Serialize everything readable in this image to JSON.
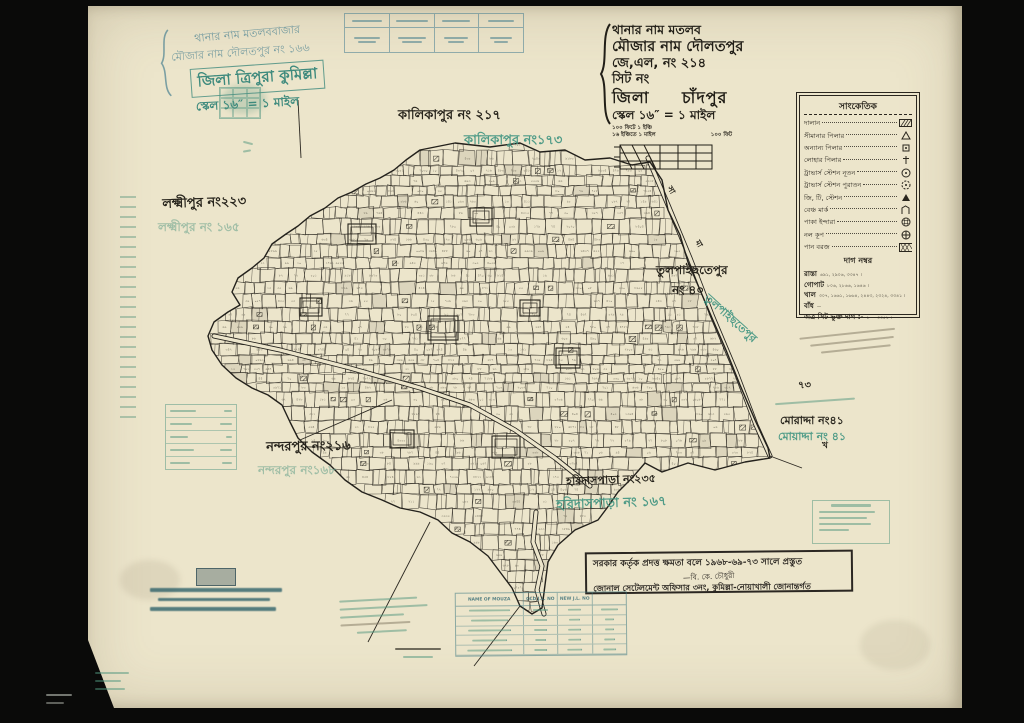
{
  "sheet": {
    "kind": "cadastral-mouza-map",
    "paper_color": "#ece5cb",
    "black_ink": "#26231b",
    "teal_ink": "#47898b",
    "green_ink": "#3f9480"
  },
  "title_left": {
    "line1": "থানার নাম মতলববাজার",
    "line2": "মৌজার নাম দৌলতপুর নং ১৬৬",
    "district_box": "জিলা ত্রিপুরা কুমিল্লা",
    "scale": "স্কেল ১৬″ = ১ মাইল"
  },
  "header_right": {
    "thana": "থানার নাম মতলব",
    "mouza": "মৌজার নাম দৌলতপুর",
    "jl_no": "জে,এল, নং ২১৪",
    "sheet_no": "সিট নং",
    "district_label": "জিলা",
    "district_value": "চাঁদপুর",
    "scale": "স্কেল ১৬″ = ১ মাইল",
    "scale_note1": "১০০ ফিটে  ১ ইঞ্চি",
    "scale_note2": "১৬ ইঞ্চিতে  ১ মাইল",
    "scale_note3": "১০০ ফিট"
  },
  "legend": {
    "title": "সাংকেতিক",
    "items": [
      {
        "label": "দালান",
        "symbol": "building-hatch"
      },
      {
        "label": "সীমানার পিলার",
        "symbol": "triangle-outline"
      },
      {
        "label": "অন্যান্য পিলার",
        "symbol": "square-dot"
      },
      {
        "label": "লোহার পিলার",
        "symbol": "iron-cross"
      },
      {
        "label": "ট্রাভার্স স্টেশন নূতন",
        "symbol": "circle-dot"
      },
      {
        "label": "ট্রাভার্স স্টেশন পুরাতন",
        "symbol": "circle-dashed"
      },
      {
        "label": "জি, টি, স্টেশন",
        "symbol": "triangle-filled"
      },
      {
        "label": "বেঞ্চ মার্ক",
        "symbol": "bench-mark"
      },
      {
        "label": "পাকা ইন্দারা",
        "symbol": "masonry-well"
      },
      {
        "label": "নল কূপ",
        "symbol": "tube-well"
      },
      {
        "label": "পান বরজ",
        "symbol": "pan-crosshatch"
      }
    ],
    "dag_title": "দাগ নম্বর",
    "dag_rows": [
      {
        "label": "রাস্তা",
        "value": "৬৯১, ২৯০৬, ৩৩৪৭ ।"
      },
      {
        "label": "গোপাট",
        "value": "৮০৬, ২৮৬৬, ১৬৪৬ ।"
      },
      {
        "label": "খাল",
        "value": "৩০৭, ১৬৬১, ১৬৬৪, ২৪৪৩, ২৩২৪, ৩৩৪১ ।"
      },
      {
        "label": "বাঁধ",
        "value": "—"
      },
      {
        "label": "অত্র সিট ভুক্ত দাগ :-",
        "value": "১ — ৩৩৫১ ।"
      }
    ]
  },
  "stamp_box": {
    "line1": "সরকার কর্তৃক প্রদত্ত ক্ষমতা বলে ১৯৬৮-৬৯-৭৩ সালে প্রস্তুত",
    "signature": "—বি. কে. চৌধুরী",
    "line2": "জোনাল সেটেলমেন্ট অফিসার ৩নং, কুমিল্লা-নোয়াখালী জোনান্তর্গত"
  },
  "bottom_table": {
    "headers": [
      "NAME OF MOUZA",
      "OLD J.L. NO",
      "NEW J.L. NO",
      ""
    ]
  },
  "map_labels": [
    {
      "text": "কালিকাপুর নং ২১৭",
      "x": 398,
      "y": 106,
      "size": 13,
      "color": "black",
      "rot": 0
    },
    {
      "text": "কালিকাপুর নং১৭৩",
      "x": 464,
      "y": 131,
      "size": 13,
      "color": "green",
      "rot": 0
    },
    {
      "text": "লক্ষ্মীপুর নং২২৩",
      "x": 162,
      "y": 195,
      "size": 13,
      "color": "black",
      "rot": -2
    },
    {
      "text": "লক্ষ্মীপুর নং ১৬৫",
      "x": 158,
      "y": 219,
      "size": 12,
      "color": "faint",
      "rot": 0
    },
    {
      "text": "তুলপাইছতেপুর",
      "x": 656,
      "y": 262,
      "size": 12,
      "color": "black",
      "rot": 0
    },
    {
      "text": "নং ৪০",
      "x": 672,
      "y": 282,
      "size": 12,
      "color": "black",
      "rot": 0
    },
    {
      "text": "তুলপাইছতেপুর",
      "x": 712,
      "y": 290,
      "size": 11,
      "color": "green",
      "rot": 42
    },
    {
      "text": "নন্দরপুর নং২১৬",
      "x": 266,
      "y": 438,
      "size": 13,
      "color": "black",
      "rot": -1
    },
    {
      "text": "নন্দরপুর নং১৬৮",
      "x": 258,
      "y": 462,
      "size": 12,
      "color": "faint",
      "rot": 0
    },
    {
      "text": "হরিদাসপাড়া নং২৩৫",
      "x": 566,
      "y": 473,
      "size": 11,
      "color": "black",
      "rot": -2
    },
    {
      "text": "হরিদাসপাড়া নং ১৬৭",
      "x": 556,
      "y": 496,
      "size": 13,
      "color": "green",
      "rot": -2
    },
    {
      "text": "মোরাদ্দা নং৪১",
      "x": 780,
      "y": 412,
      "size": 11,
      "color": "black",
      "rot": 0
    },
    {
      "text": "মোয়াদ্দা নং ৪১",
      "x": 778,
      "y": 428,
      "size": 11,
      "color": "green",
      "rot": 0
    },
    {
      "text": "৭৩",
      "x": 798,
      "y": 378,
      "size": 10,
      "color": "black",
      "rot": 0
    },
    {
      "text": "সা",
      "x": 674,
      "y": 184,
      "size": 8,
      "color": "black",
      "rot": 60
    },
    {
      "text": "মা",
      "x": 702,
      "y": 238,
      "size": 8,
      "color": "black",
      "rot": 60
    },
    {
      "text": "খ",
      "x": 822,
      "y": 438,
      "size": 9,
      "color": "black",
      "rot": 0
    }
  ],
  "map": {
    "seed": 11,
    "digits": "০১২৩৪৫৬৭৮৯",
    "boundary": [
      [
        420,
        150
      ],
      [
        455,
        143
      ],
      [
        490,
        147
      ],
      [
        520,
        143
      ],
      [
        540,
        152
      ],
      [
        565,
        150
      ],
      [
        585,
        160
      ],
      [
        610,
        158
      ],
      [
        632,
        165
      ],
      [
        650,
        162
      ],
      [
        662,
        180
      ],
      [
        668,
        210
      ],
      [
        680,
        235
      ],
      [
        688,
        262
      ],
      [
        700,
        290
      ],
      [
        712,
        318
      ],
      [
        726,
        350
      ],
      [
        740,
        385
      ],
      [
        755,
        420
      ],
      [
        768,
        448
      ],
      [
        770,
        458
      ],
      [
        745,
        462
      ],
      [
        715,
        470
      ],
      [
        688,
        463
      ],
      [
        662,
        472
      ],
      [
        645,
        463
      ],
      [
        632,
        478
      ],
      [
        618,
        492
      ],
      [
        607,
        508
      ],
      [
        598,
        520
      ],
      [
        575,
        530
      ],
      [
        558,
        545
      ],
      [
        548,
        562
      ],
      [
        545,
        585
      ],
      [
        542,
        608
      ],
      [
        532,
        614
      ],
      [
        520,
        606
      ],
      [
        512,
        588
      ],
      [
        500,
        572
      ],
      [
        488,
        556
      ],
      [
        470,
        542
      ],
      [
        452,
        533
      ],
      [
        438,
        520
      ],
      [
        420,
        512
      ],
      [
        400,
        508
      ],
      [
        382,
        500
      ],
      [
        362,
        492
      ],
      [
        345,
        480
      ],
      [
        330,
        465
      ],
      [
        312,
        452
      ],
      [
        298,
        438
      ],
      [
        290,
        422
      ],
      [
        282,
        405
      ],
      [
        268,
        395
      ],
      [
        252,
        388
      ],
      [
        236,
        378
      ],
      [
        222,
        365
      ],
      [
        212,
        350
      ],
      [
        208,
        336
      ],
      [
        214,
        322
      ],
      [
        228,
        312
      ],
      [
        240,
        305
      ],
      [
        232,
        292
      ],
      [
        238,
        278
      ],
      [
        252,
        268
      ],
      [
        264,
        258
      ],
      [
        272,
        244
      ],
      [
        286,
        234
      ],
      [
        298,
        226
      ],
      [
        310,
        216
      ],
      [
        325,
        208
      ],
      [
        338,
        198
      ],
      [
        352,
        192
      ],
      [
        366,
        184
      ],
      [
        380,
        178
      ],
      [
        394,
        170
      ],
      [
        406,
        160
      ]
    ],
    "compounds": [
      [
        348,
        224,
        28,
        20
      ],
      [
        428,
        316,
        30,
        24
      ],
      [
        492,
        436,
        28,
        22
      ],
      [
        300,
        298,
        22,
        18
      ],
      [
        556,
        348,
        24,
        20
      ],
      [
        470,
        208,
        22,
        18
      ],
      [
        390,
        430,
        24,
        18
      ],
      [
        520,
        300,
        20,
        16
      ]
    ],
    "roads_double": [
      [
        [
          648,
          158
        ],
        [
          668,
          205
        ],
        [
          690,
          258
        ],
        [
          712,
          315
        ],
        [
          736,
          372
        ],
        [
          756,
          425
        ],
        [
          770,
          456
        ]
      ],
      [
        [
          536,
          512
        ],
        [
          533,
          542
        ],
        [
          542,
          566
        ],
        [
          537,
          590
        ],
        [
          544,
          614
        ]
      ],
      [
        [
          214,
          336
        ],
        [
          280,
          350
        ],
        [
          350,
          368
        ],
        [
          420,
          388
        ],
        [
          470,
          405
        ],
        [
          515,
          430
        ],
        [
          555,
          458
        ],
        [
          590,
          486
        ]
      ]
    ],
    "roads_single": [
      [
        [
          298,
          100
        ],
        [
          301,
          158
        ]
      ],
      [
        [
          300,
          440
        ],
        [
          392,
          400
        ]
      ],
      [
        [
          430,
          522
        ],
        [
          368,
          642
        ]
      ],
      [
        [
          520,
          606
        ],
        [
          474,
          666
        ]
      ],
      [
        [
          770,
          456
        ],
        [
          802,
          468
        ]
      ]
    ]
  }
}
